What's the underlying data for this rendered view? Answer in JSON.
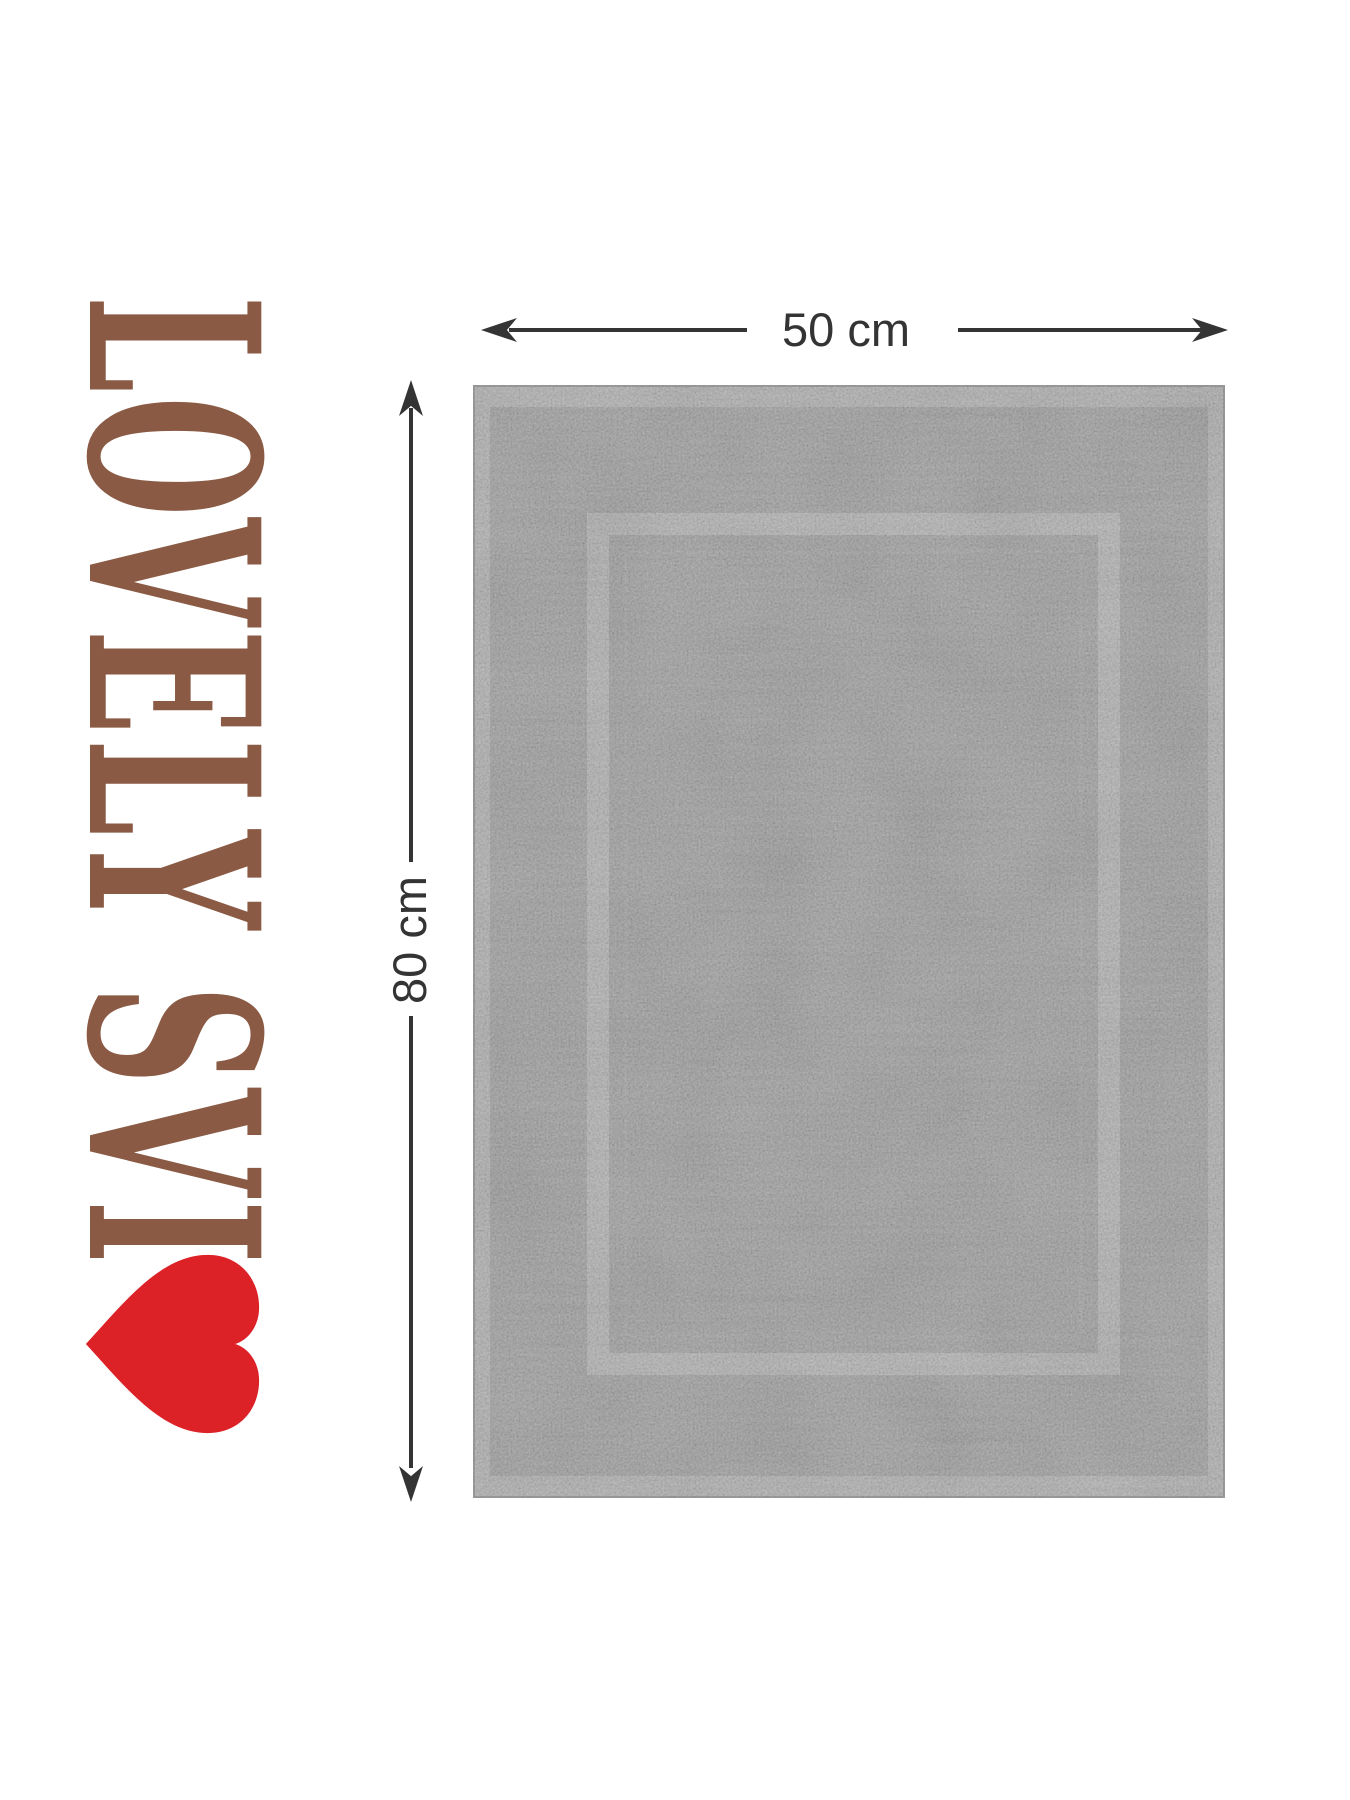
{
  "brand": {
    "name": "LOVELY SVI",
    "text_color": "#8a5a44",
    "heart_color": "#dc2127"
  },
  "size_annotations": {
    "width_label": "50 cm",
    "height_label": "80 cm",
    "color": "#343434"
  },
  "mat": {
    "base_color": "#8e8e8e",
    "hem_color": "#a6a6a6",
    "frame_color": "#a9a9a9"
  }
}
